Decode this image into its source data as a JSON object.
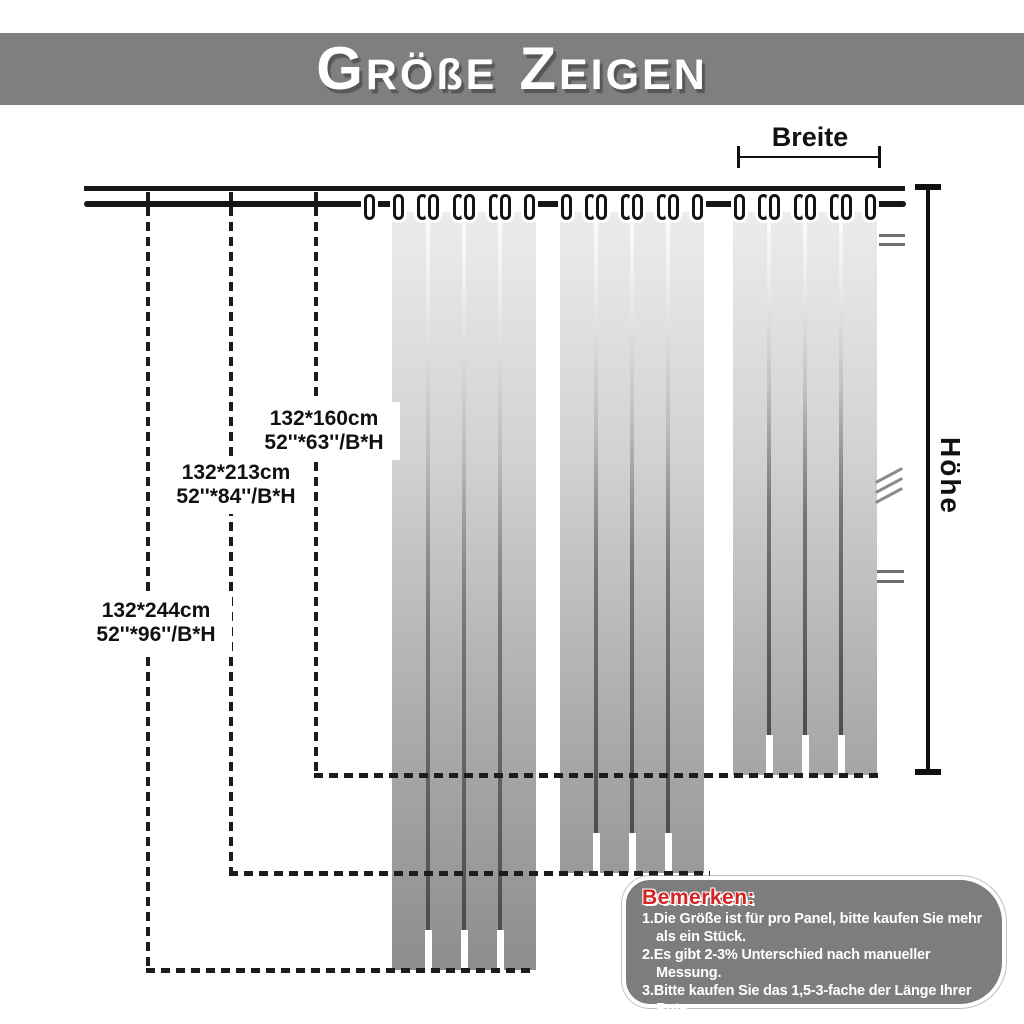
{
  "header": {
    "title": "GRÖßE ZEIGEN",
    "part1_initial": "G",
    "part1_rest": "RÖßE",
    "part2_initial": "Z",
    "part2_rest": "EIGEN"
  },
  "measurements": {
    "width_label": "Breite",
    "height_label": "Höhe"
  },
  "sizes": [
    {
      "cm": "132*160cm",
      "inch": "52''*63''/B*H"
    },
    {
      "cm": "132*213cm",
      "inch": "52''*84''/B*H"
    },
    {
      "cm": "132*244cm",
      "inch": "52''*96''/B*H"
    }
  ],
  "notes": {
    "title": "Bemerken:",
    "lines": [
      {
        "text": "1.Die Größe ist für pro Panel, bitte kaufen Sie mehr",
        "indent": false
      },
      {
        "text": "als ein Stück.",
        "indent": true
      },
      {
        "text": "2.Es gibt 2-3% Unterschied nach manueller",
        "indent": false
      },
      {
        "text": "Messung.",
        "indent": true
      },
      {
        "text": "3.Bitte kaufen Sie das 1,5-3-fache der Länge Ihrer",
        "indent": false
      },
      {
        "text": "Rute.",
        "indent": true
      }
    ]
  },
  "colors": {
    "header_band": "#7f7f7f",
    "notes_box": "#7d7d7d",
    "notes_title_red": "#d42424",
    "curtain_top": "#ececec",
    "curtain_bottom": "#8d8d8d",
    "line_black": "#161616"
  }
}
